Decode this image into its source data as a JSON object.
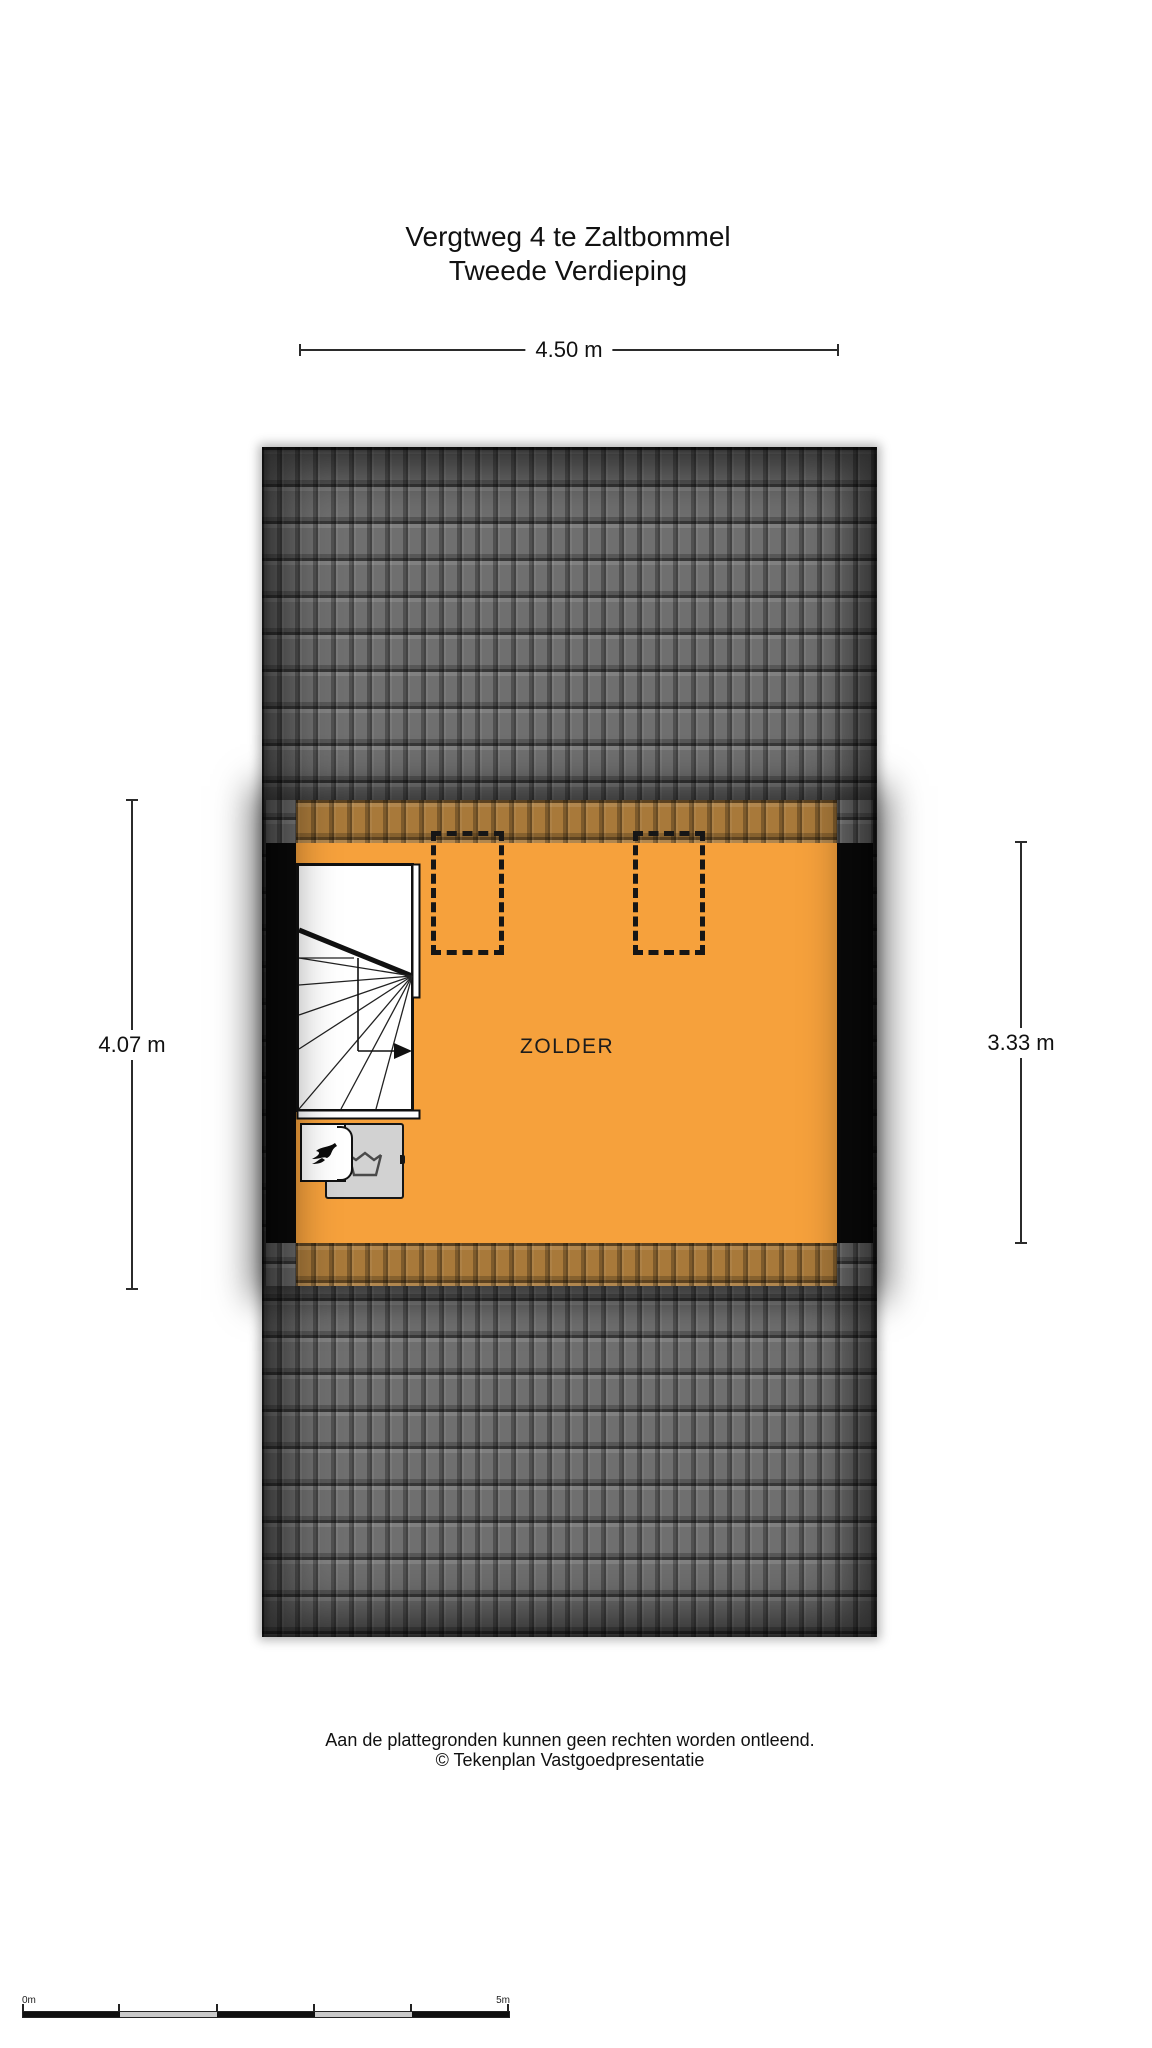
{
  "header": {
    "title_line1": "Vergtweg 4 te Zaltbommel",
    "title_line2": "Tweede Verdieping"
  },
  "dimensions": {
    "top": "4.50 m",
    "left": "4.07 m",
    "right": "3.33 m"
  },
  "floorplan": {
    "room_label": "ZOLDER",
    "features": [
      "roof tiles",
      "attic room",
      "two skylights (dashed)",
      "winder staircase with direction arrow",
      "boiler with flame symbol",
      "washing machine with laundry-tub symbol"
    ]
  },
  "footer": {
    "line1": "Aan de plattegronden kunnen geen rechten worden ontleend.",
    "line2": "© Tekenplan Vastgoedpresentatie"
  },
  "scale_bar": {
    "start_label": "0m",
    "end_label": "5m",
    "segments": 5
  },
  "colors": {
    "room_orange": "#F6A13C",
    "roof_tile_gray": "#6F6F6F",
    "roof_edge_dark": "#1C1C1C",
    "tinted_roof_band": "#A8793A",
    "wall_black": "#0B0B0B",
    "appliance_gray": "#D2D2D2",
    "dimension_line": "#2B2B2B",
    "background": "#FFFFFF"
  },
  "icons": {
    "flame-icon": "black flame glyph on boiler",
    "laundry-icon": "wash-tub outline with wavy water line",
    "stairs-direction-arrow-icon": "black right-pointing arrow on walking line",
    "skylight-icon": "dashed rectangle roof window"
  }
}
